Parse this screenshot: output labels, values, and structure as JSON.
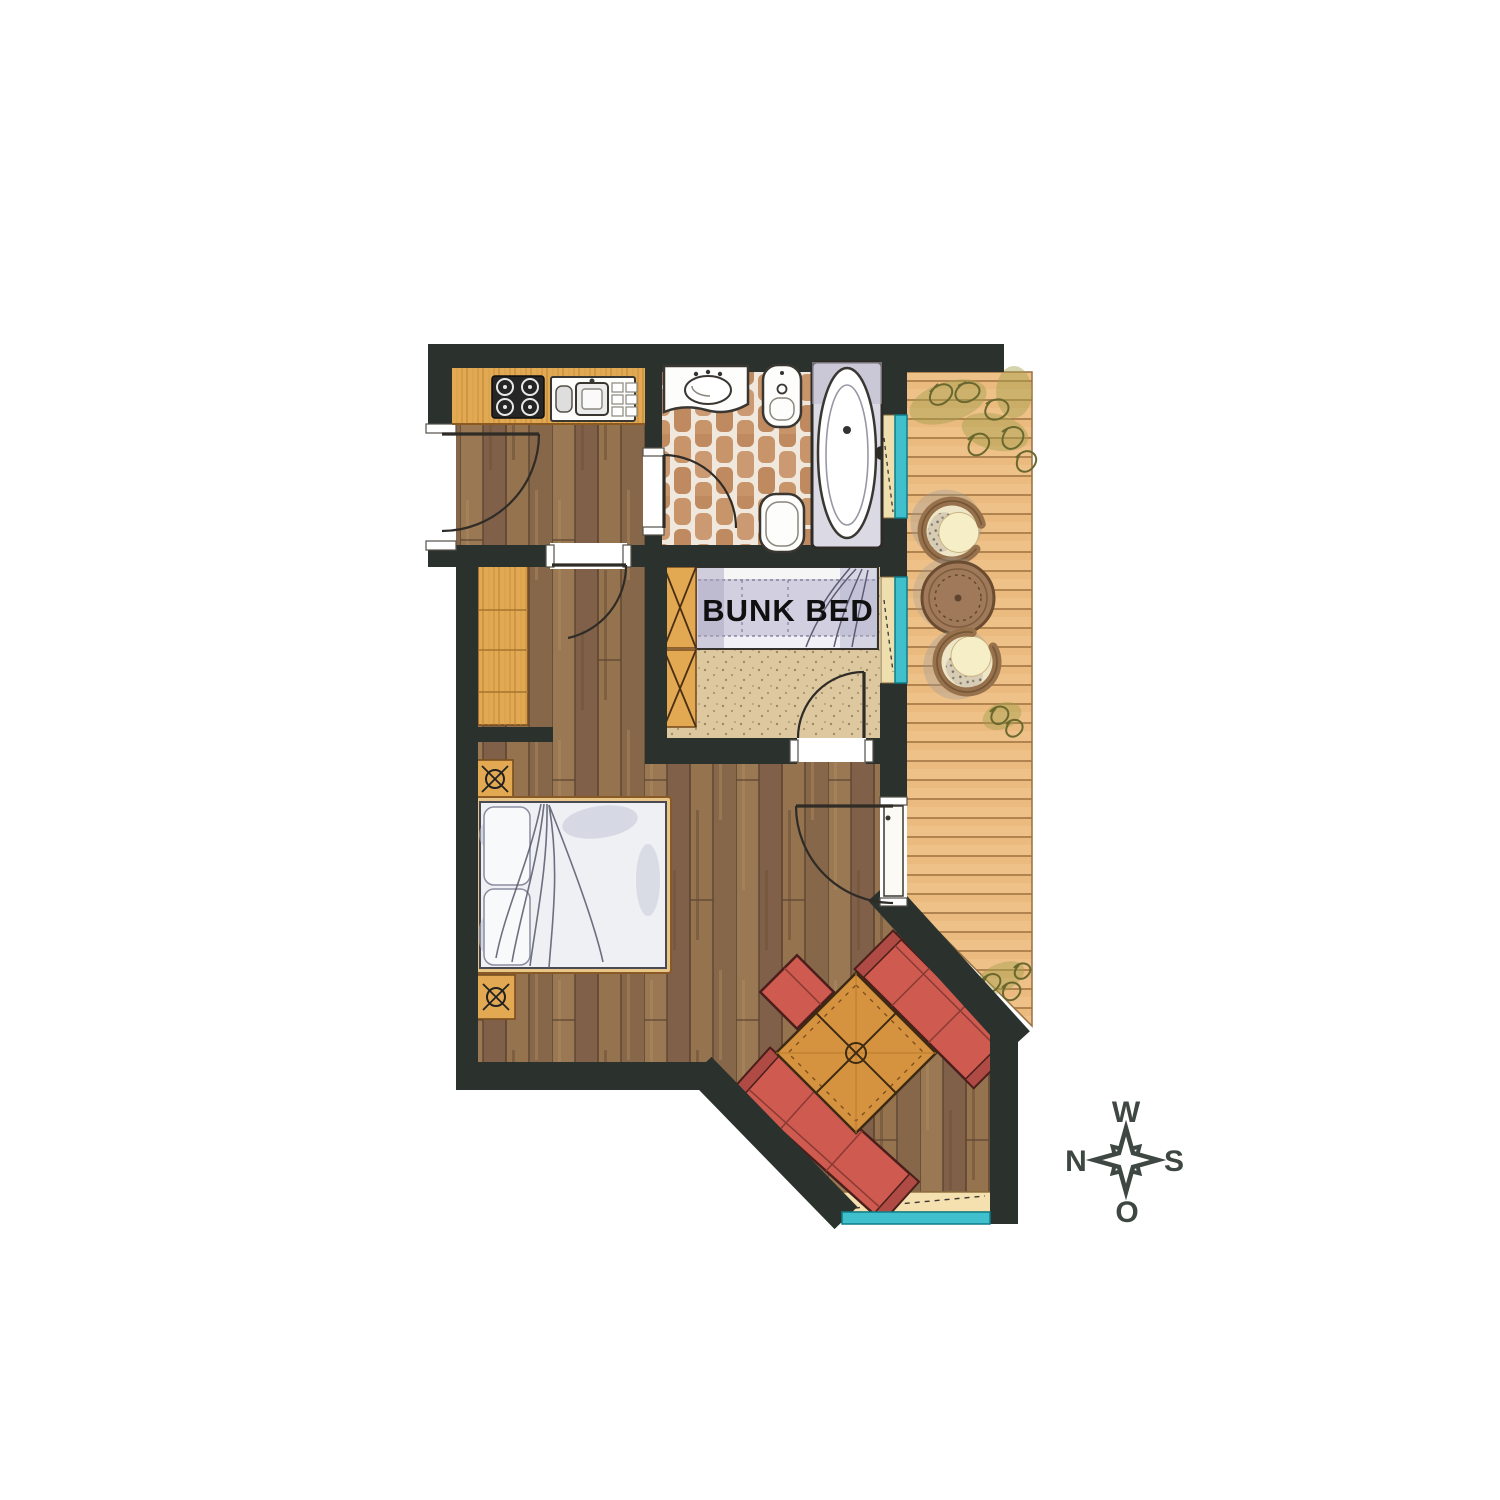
{
  "page": {
    "background": "#ffffff",
    "type": "floor-plan-illustration"
  },
  "labels": {
    "bunk_bed": "BUNK BED"
  },
  "compass": {
    "top": "W",
    "right": "S",
    "bottom": "O",
    "left": "N"
  },
  "rooms": {
    "kitchen": {
      "fixtures": [
        "stove-4-burner",
        "kitchen-sink-with-drainboard"
      ]
    },
    "bathroom": {
      "fixtures": [
        "washbasin",
        "bidet",
        "toilet",
        "bathtub"
      ],
      "floor": "terracotta-tile"
    },
    "bunk_room": {
      "fixtures": [
        "ladder",
        "bunk-bed"
      ],
      "label": "BUNK BED"
    },
    "bedroom": {
      "fixtures": [
        "double-bed",
        "nightstand-lamp",
        "nightstand-lamp",
        "wardrobe"
      ]
    },
    "living_nook": {
      "fixtures": [
        "corner-sofa",
        "square-coffee-table",
        "window-bench"
      ]
    },
    "terrace": {
      "fixtures": [
        "wicker-chair",
        "round-table",
        "wicker-chair",
        "plants"
      ],
      "floor": "wood-deck"
    }
  },
  "colors": {
    "wall": "#2b322d",
    "floor-wood": "#8f6f4f",
    "floor-seam": "#5d4531",
    "counter-wood": "#e2a952",
    "grain-line": "#c18a3c",
    "tile": "#c8946a",
    "tile-bg": "#f0e8dc",
    "deck": "#eec189",
    "deck-line": "#a87b48",
    "window-teal": "#3fc0cc",
    "sofa-red": "#ce5a50",
    "table-wood": "#d6933f",
    "bedding": "#d2d0e0",
    "bed-white": "#eef0f4",
    "bench": "#f5e1b0",
    "beige-floor": "#ddc89f",
    "plant-olive": "#a5a04b",
    "compass-ink": "#3e4742",
    "label-ink": "#101010"
  }
}
